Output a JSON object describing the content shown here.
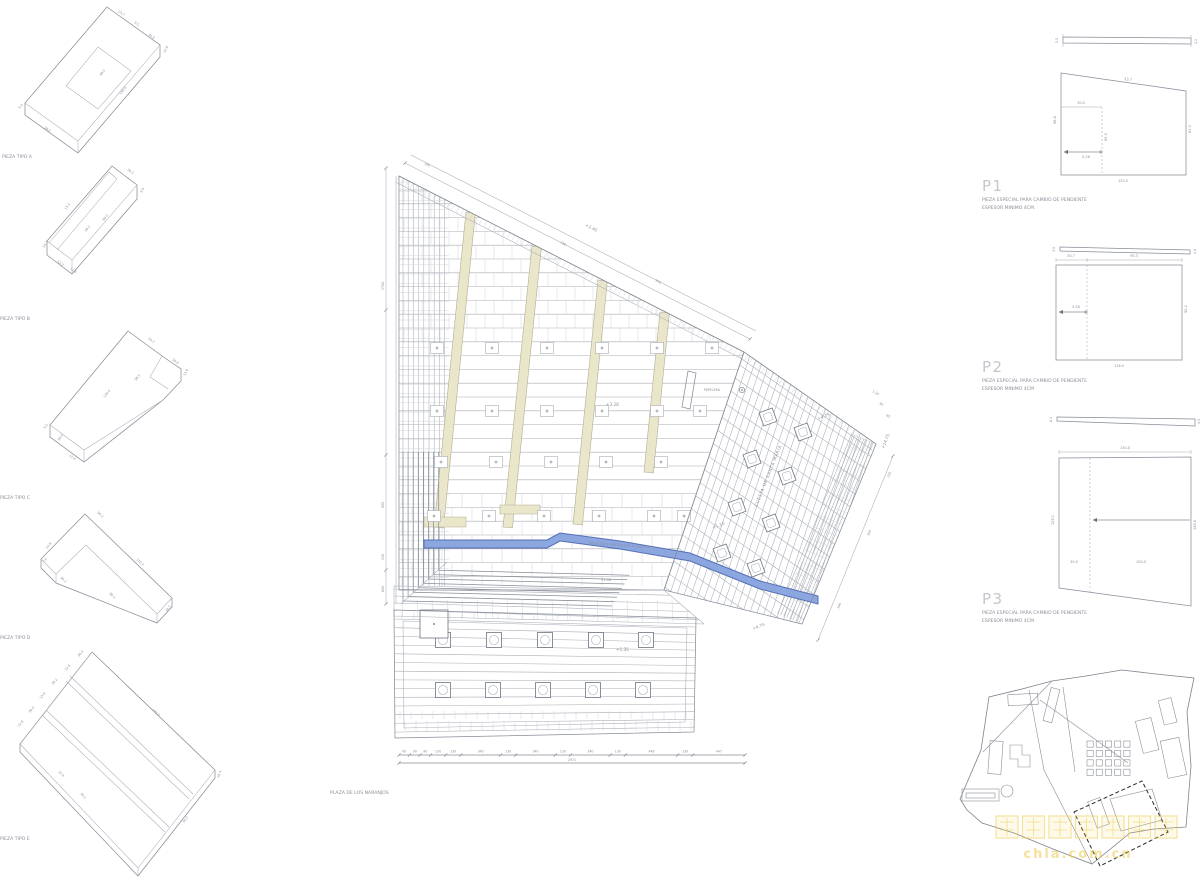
{
  "drawing": {
    "pieces": [
      {
        "label": "PIEZA TIPO A",
        "dims": [
          "23.7",
          "9.5",
          "30.8",
          "12.8",
          "48.0",
          "139.0",
          "9.0",
          "36.0"
        ]
      },
      {
        "label": "PIEZA TIPO B",
        "dims": [
          "36.3",
          "9.0",
          "13.3",
          "53.7",
          "36.0",
          "89.0",
          "12.8",
          "52.3"
        ]
      },
      {
        "label": "PIEZA TIPO C",
        "dims": [
          "50.2",
          "36.8",
          "13.0",
          "139.0",
          "38.3",
          "12.8",
          "36.0",
          "9.0"
        ]
      },
      {
        "label": "PIEZA TIPO D",
        "dims": [
          "50.2",
          "13.8",
          "36.2",
          "7.0",
          "170.2",
          "90.2",
          "36.5"
        ]
      },
      {
        "label": "PIEZA TIPO E",
        "dims": [
          "36.0",
          "12.8",
          "36.2",
          "13.8",
          "36.0",
          "12.8",
          "185.0",
          "25.8",
          "36.1",
          "90.0",
          "28.4"
        ]
      }
    ],
    "plan": {
      "name": "PLAZA DE LOS NARANJOS",
      "levels": {
        "top": "+1.40",
        "field": "+3.28",
        "steps_a": "+1.15",
        "steps_b": "+1.08",
        "ramp_a": "+4.75",
        "ramp_b": "+4.75",
        "right": "+14.75",
        "terrace": "+1.35"
      },
      "notes": {
        "acequia": "TRAZADO ANTIGUA ACEQUIA",
        "street": "CUESTA DE SANTA MARIA",
        "bin": "PAPELERA"
      },
      "dims": {
        "top": [
          "730",
          "916"
        ],
        "top_small": "180",
        "left": [
          "1700",
          "800",
          "130",
          "680"
        ],
        "right": [
          "1.10",
          "40",
          "85",
          "230",
          "590",
          "190"
        ],
        "bottom_series": [
          "90",
          "90",
          "90",
          "130",
          "130",
          "340",
          "130",
          "340",
          "130",
          "340",
          "130",
          "448",
          "130",
          "447"
        ],
        "bottom_total": "2971"
      }
    },
    "details": [
      {
        "id": "P1",
        "line1": "PIEZA ESPECIAL PARA CAMBIO DE PENDIENTE",
        "line2": "ESPESOR MINIMO 4CM.",
        "bar": [
          "5.5",
          "4.2"
        ],
        "shape": {
          "top_seg": "30.0",
          "top": "33.7",
          "left": "98.8",
          "right": "81.4",
          "bottom": "125.0",
          "inner": "65.0",
          "offset": "5.26"
        }
      },
      {
        "id": "P2",
        "line1": "PIEZA ESPECIAL PARA CAMBIO DE PENDIENTE",
        "line2": "ESPESOR MINIMO 4CM",
        "bar": [
          "3.0",
          "4.0"
        ],
        "shape": {
          "top_seg": "30.7",
          "top": "95.3",
          "right": "90.2",
          "bottom": "126.0",
          "offset": "3.26"
        }
      },
      {
        "id": "P3",
        "line1": "PIEZA ESPECIAL PARA CAMBIO DE PENDIENTE",
        "line2": "ESPESOR MINIMO 4CM.",
        "bar": [
          "6.2",
          "4.5"
        ],
        "shape": {
          "top": "130.0",
          "left": "129.1",
          "right": "146.6",
          "seg1": "30.0",
          "seg2": "100.0"
        }
      }
    ],
    "keyplan": {
      "watermark_text": "chla.com.cn"
    }
  },
  "colors": {
    "line": "#a8adb6",
    "line_dark": "#5f6571",
    "beige": "#eae6ca",
    "blue": "#8ca6e0",
    "text": "#8a8f99",
    "watermark": "#efc94c"
  }
}
